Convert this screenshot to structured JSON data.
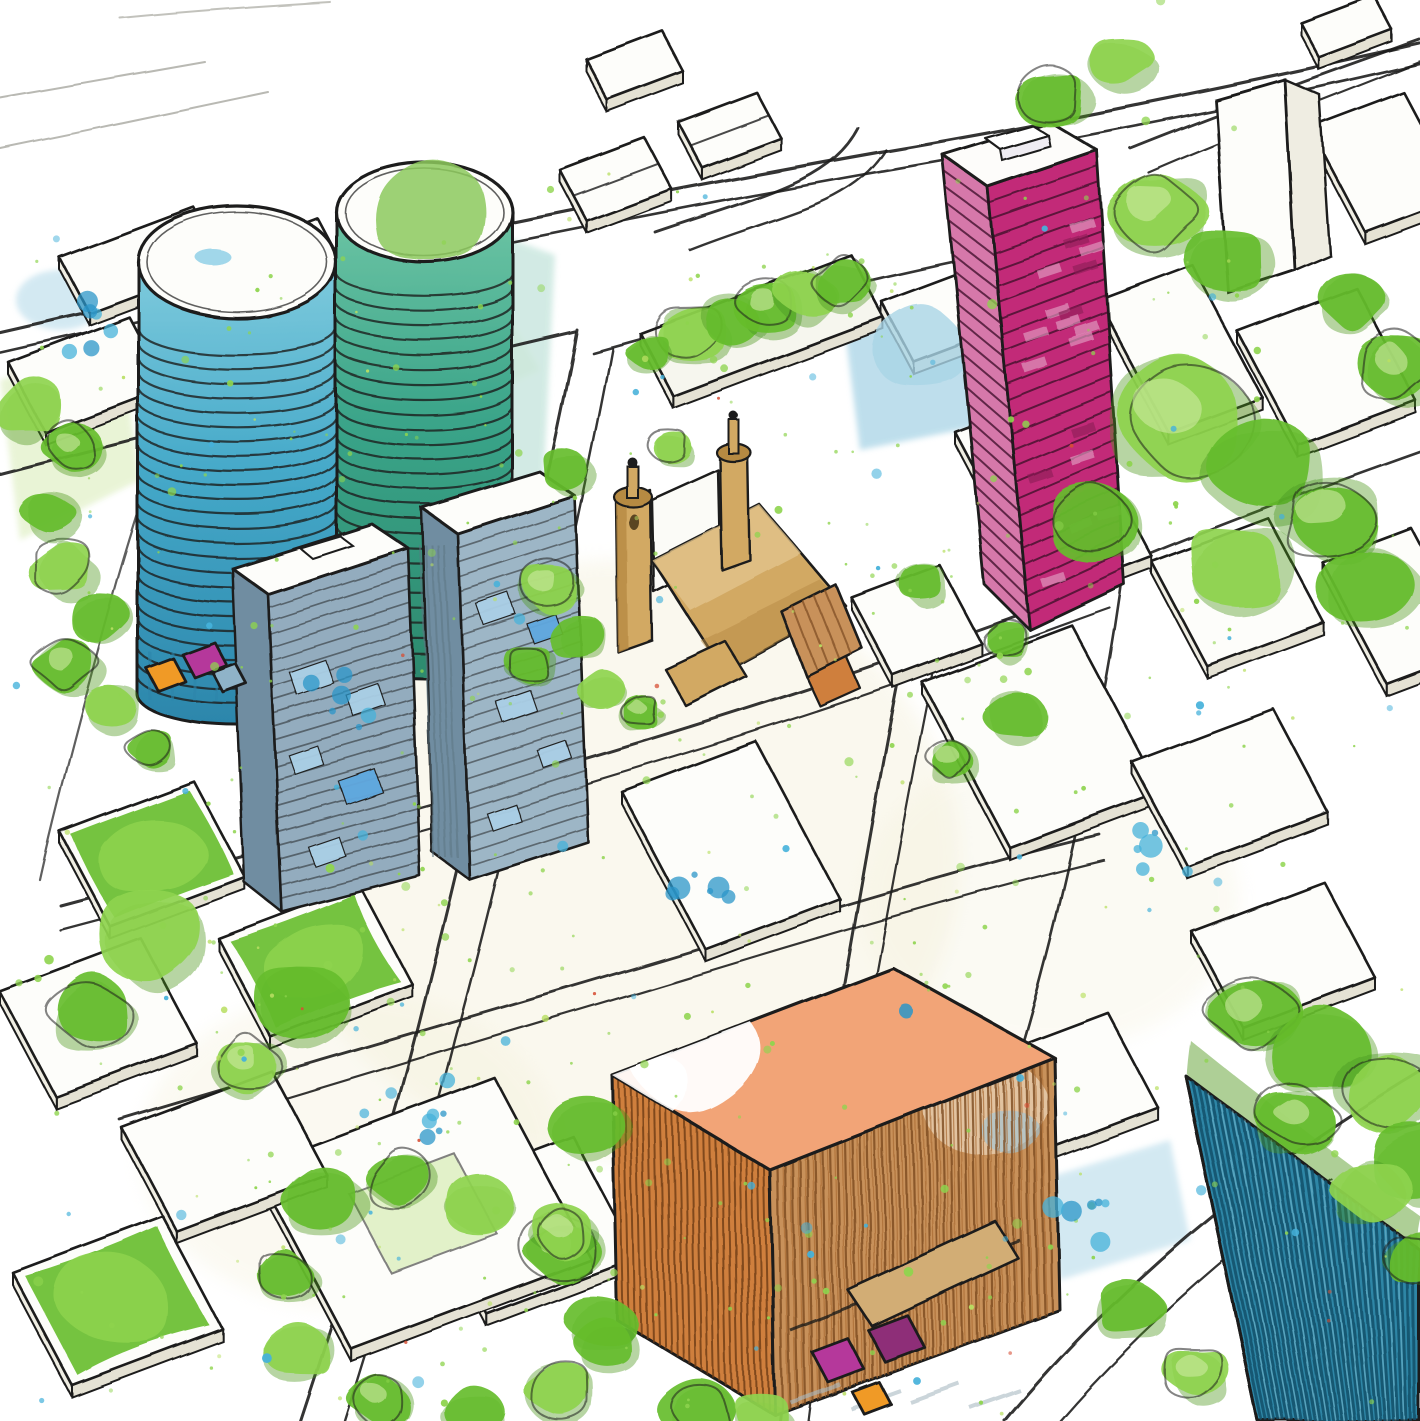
{
  "artwork": {
    "medium": "ink-and-watercolor architectural sketch",
    "view": "aerial axonometric urban masterplan",
    "contains_text": false
  },
  "elements": [
    {
      "name": "cylindrical-tower-blue",
      "fill": "tower_blue"
    },
    {
      "name": "cylindrical-tower-teal-green-cap",
      "fill": "tower_teal"
    },
    {
      "name": "magenta-highrise-tower",
      "fill": "magenta"
    },
    {
      "name": "slate-blue-midrise-slabs",
      "fill": "gray_front"
    },
    {
      "name": "tan-church-twin-spires",
      "fill": "tan"
    },
    {
      "name": "orange-timber-slat-building",
      "fill": "orange_facade"
    },
    {
      "name": "teal-slat-building-with-green-roof",
      "fill": "teal_br"
    },
    {
      "name": "linear-tree-park-strip",
      "fill": "green_mid"
    },
    {
      "name": "white-city-blocks",
      "fill": "paper"
    },
    {
      "name": "green-roof-patches",
      "fill": "green_mid"
    },
    {
      "name": "street-grid-ink-lines",
      "fill": "ink"
    },
    {
      "name": "market-kiosks",
      "fill": "purple_kiosk"
    },
    {
      "name": "watercolor-speckles",
      "fill": "green_bright"
    }
  ],
  "palette": {
    "paper": "#ffffff",
    "paper_cream": "#f4f0da",
    "block_white": "#fdfdfa",
    "block_side": "#efede2",
    "block_side2": "#e5e2d4",
    "ink": "#1d1d1c",
    "pencil": "#a8a8a0",
    "shadow_gray": "#a9bac2",
    "tower_blue_top": "#7fcbdd",
    "tower_blue": "#45a9c9",
    "tower_blue_dark": "#2c86ab",
    "tower_teal_top": "#6cc4a4",
    "tower_teal": "#3aa489",
    "tower_teal_dark": "#2d8a6e",
    "tower_green_cap": "#8cc95c",
    "magenta": "#c22b78",
    "magenta_light": "#d678aa",
    "magenta_dark": "#8f1d58",
    "magenta_line": "#3a0c26",
    "magenta_window": "#e19cc2",
    "gray_front": "#93acbe",
    "gray_front2": "#9db6c6",
    "gray_side": "#6f8da1",
    "window_blue": "#aacfe6",
    "window_bright": "#5fa8df",
    "tan": "#d2a964",
    "tan_light": "#e3c68d",
    "tan_dark": "#b68a42",
    "church_window": "#5a4420",
    "orange_roof": "#f2a477",
    "orange_facade": "#c8915a",
    "orange_left": "#cf7f3e",
    "orange_dark": "#7c4a20",
    "ramp_tan": "#d2ad74",
    "teal_br": "#2e86a6",
    "teal_br_dark": "#14506a",
    "green_bright": "#8ed44e",
    "green_mid": "#66bd2c",
    "green_dark": "#49951d",
    "green_pale": "#cde9a2",
    "green_wash": "#e4f2cd",
    "aqua_wash": "#c8e6de",
    "blue_wash": "#a9d4e6",
    "blue_speckle": "#45b1da",
    "blue_deep": "#2b96c8",
    "yellow_green": "#b9df63",
    "red_speckle": "#d64f35",
    "purple_kiosk": "#b5399b",
    "purple_kiosk_dark": "#8e2f78",
    "orange_kiosk": "#f09a28"
  },
  "texture": {
    "speckles": {
      "green": {
        "count": 430,
        "rmin": 1.2,
        "rmax": 5.5
      },
      "yellow": {
        "count": 90,
        "rmin": 1.2,
        "rmax": 4.0
      },
      "blue": {
        "count": 85,
        "rmin": 2.0,
        "rmax": 8.0
      },
      "red": {
        "count": 16,
        "rmin": 1.5,
        "rmax": 3.2
      }
    },
    "tower_rings": {
      "blue": 25,
      "teal": 25
    },
    "slab_floor_lines": 24,
    "magenta_floor_lines": 27,
    "slat_step": 8
  }
}
